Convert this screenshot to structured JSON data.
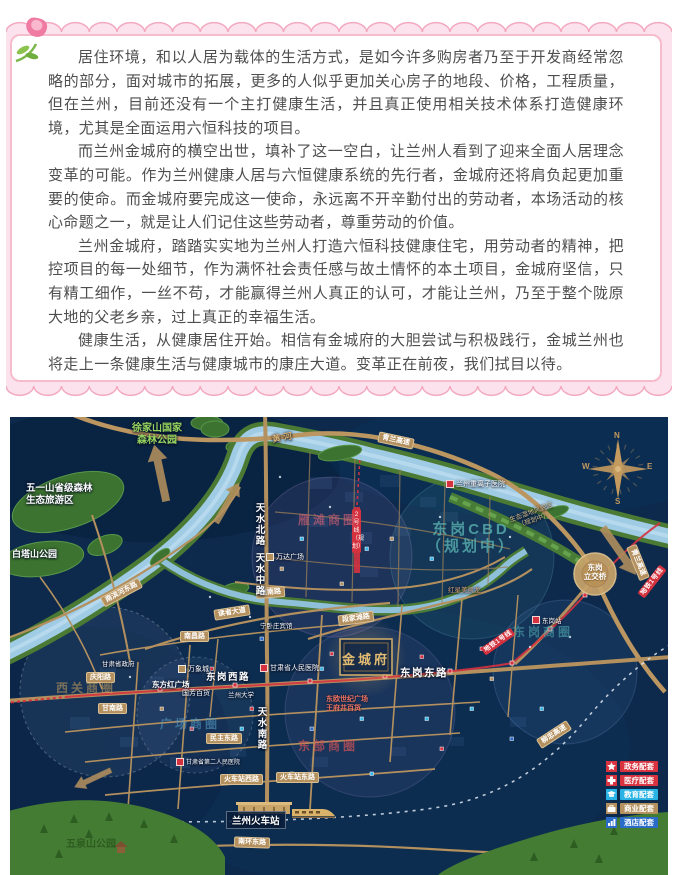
{
  "article": {
    "paragraphs": [
      "居住环境，和以人居为载体的生活方式，是如今许多购房者乃至于开发商经常忽略的部分，面对城市的拓展，更多的人似乎更加关心房子的地段、价格，工程质量，但在兰州，目前还没有一个主打健康生活，并且真正使用相关技术体系打造健康环境，尤其是全面运用六恒科技的项目。",
      "而兰州金城府的横空出世，填补了这一空白，让兰州人看到了迎来全面人居理念变革的可能。作为兰州健康人居与六恒健康系统的先行者，金城府还将肩负起更加重要的使命。而金城府要完成这一使命，永远离不开辛勤付出的劳动者，本场活动的核心命题之一，就是让人们记住这些劳动者，尊重劳动的价值。",
      "兰州金城府，踏踏实实地为兰州人打造六恒科技健康住宅，用劳动者的精神，把控项目的每一处细节，作为满怀社会责任感与故土情怀的本土项目，金城府坚信，只有精工细作，一丝不苟，才能赢得兰州人真正的认可，才能让兰州，乃至于整个陇原大地的父老乡亲，过上真正的幸福生活。",
      "健康生活，从健康居住开始。相信有金城府的大胆尝试与积极践行，金城兰州也将走上一条健康生活与健康城市的康庄大道。变革正在前夜，我们拭目以待。"
    ]
  },
  "map": {
    "river": "黄河",
    "roads": {
      "qinglan": "青兰高速",
      "liuzhong": "柳忠高速",
      "tianshui_n": "天水北路",
      "tianshui_m": "天水中路",
      "tianshui_s": "天水南路",
      "donggang_w": "东岗西路",
      "donggang_e": "东岗东路",
      "duanjiatan": "段家滩路",
      "reader": "读者大道",
      "nanchang": "南昌路",
      "gannan": "甘南路",
      "qingyang": "庆阳路",
      "minzhu": "民主东路",
      "station_w": "火车站西路",
      "station_e": "火车站东路",
      "nanhuan": "南环东路",
      "yannan": "雁南路",
      "binhe": "南滨河东路"
    },
    "metro": {
      "line1": "地铁1号线",
      "line2": "2号线（规划）"
    },
    "parks": {
      "xujiashan": [
        "徐家山国家",
        "森林公园"
      ],
      "wuyi": [
        "五一山省级森林",
        "生态旅游区"
      ],
      "baita": "白塔山公园",
      "wuquan": "五泉山公园",
      "wetland": [
        "生态湿地风貌区",
        "（规划中）"
      ]
    },
    "districts": {
      "yantan": "雁滩商圈",
      "cbd": [
        "东岗CBD",
        "（规划中）"
      ],
      "xiguan": "西关商圈",
      "guangchang": "广场商圈",
      "donggang": "东岗商圈",
      "dongbu": "东部商圈"
    },
    "pois": {
      "project": "金城府",
      "interchange": [
        "东岗",
        "立交桥"
      ],
      "railway_station": "兰州火车站",
      "heavy_ion": "兰州重离子医院",
      "people_hospital": "甘肃省人民医院",
      "second_hospital": "甘肃省第二人民医院",
      "dfh_square": "东方红广场",
      "wanxiang": "万象城",
      "guofang": "国芳百货",
      "wanda": "万达广场",
      "dongou": [
        "东欧世纪广场",
        "王府井百货"
      ],
      "redstar": "红星美凯龙",
      "gov": "甘肃省政府",
      "ningwozhuang": "宁卧庄宾馆",
      "lzu": "兰州大学",
      "donggang_stn": "东岗站"
    },
    "compass": {
      "n": "N",
      "s": "S",
      "w": "W",
      "e": "E"
    },
    "legend": {
      "items": [
        {
          "label": "政务配套",
          "color": "#d8333f",
          "icon": "star"
        },
        {
          "label": "医疗配套",
          "color": "#d8333f",
          "icon": "cross"
        },
        {
          "label": "教育配套",
          "color": "#29b2e4",
          "icon": "graduation-cap"
        },
        {
          "label": "商业配套",
          "color": "#b3905e",
          "icon": "briefcase"
        },
        {
          "label": "酒店配套",
          "color": "#2a6bc8",
          "icon": "building"
        }
      ]
    },
    "colors": {
      "water": "#9fcbe4",
      "road": "#b3905e",
      "metro": "#d5323f",
      "park": "#3c7330",
      "gold": "#e3bc72"
    }
  }
}
